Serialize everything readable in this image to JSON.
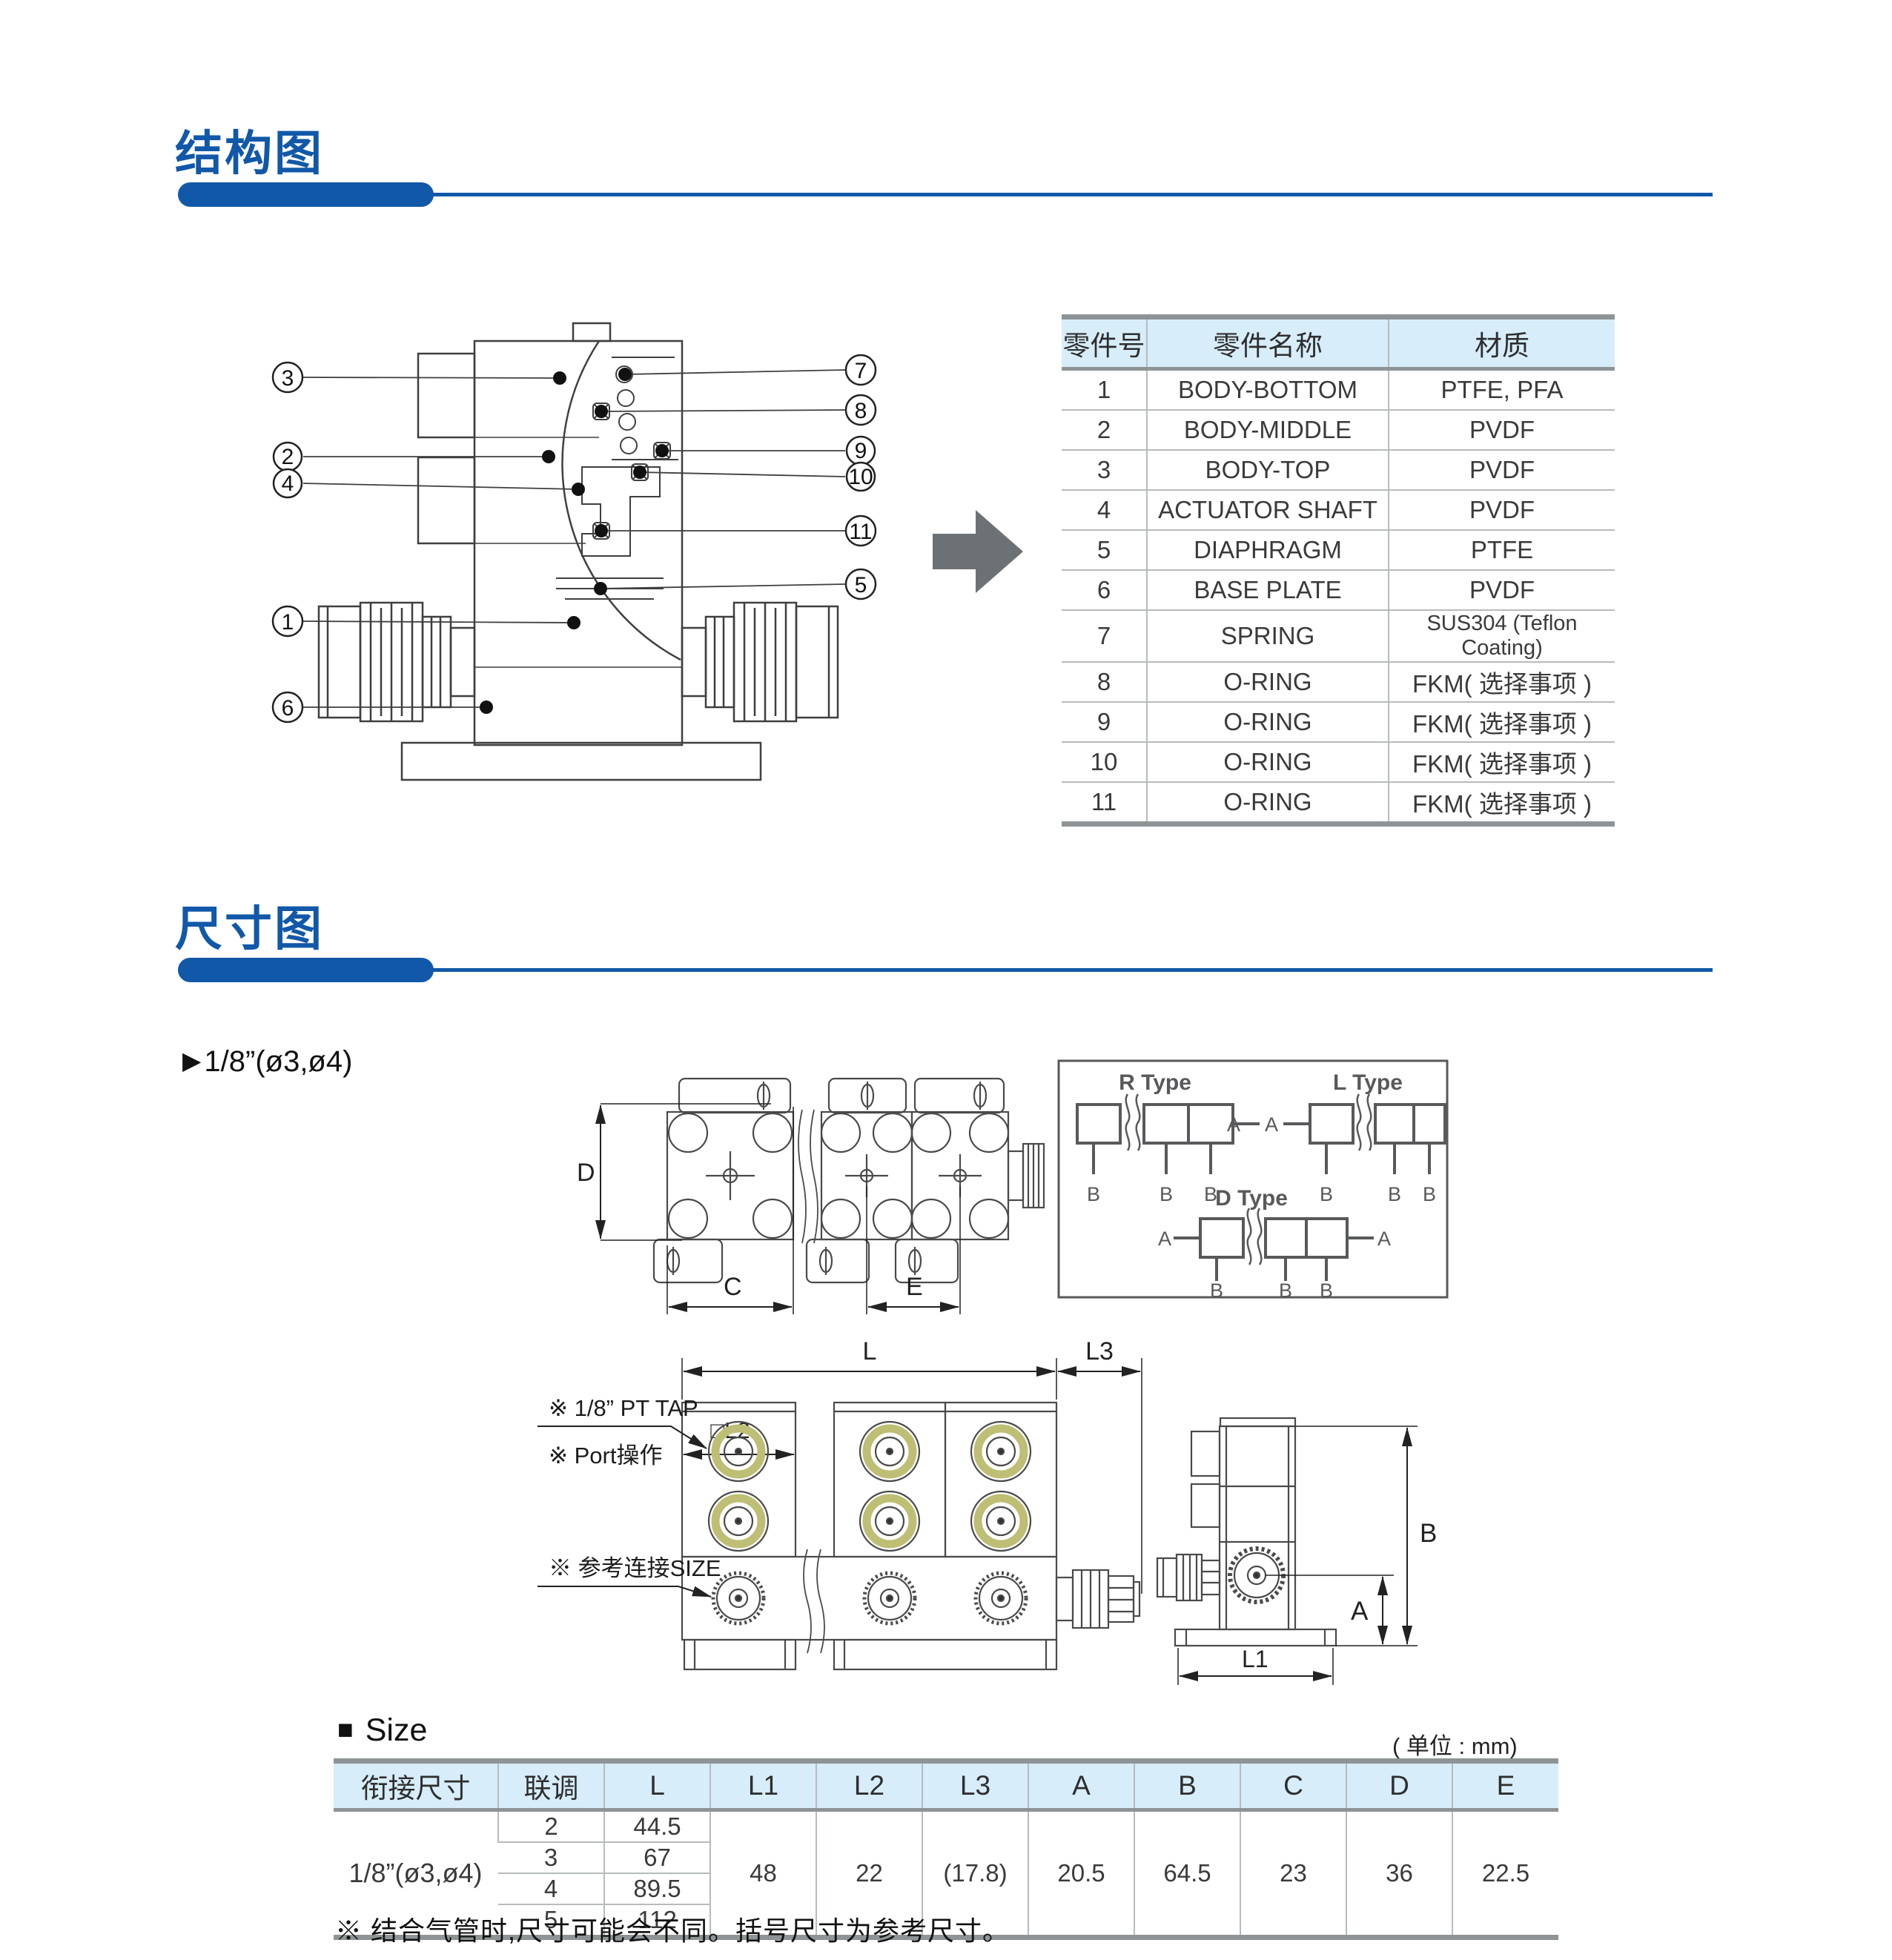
{
  "colors": {
    "accent_blue": "#1158A8",
    "table_header_bg": "#D7EDF9",
    "heavy_border_gray": "#8E9396",
    "port_ring_olive": "#BEBE74",
    "arrow_gray": "#6C7176"
  },
  "structure_section": {
    "title": "结构图",
    "parts_table": {
      "headers": [
        "零件号",
        "零件名称",
        "材质"
      ],
      "rows": [
        [
          "1",
          "BODY-BOTTOM",
          "PTFE, PFA"
        ],
        [
          "2",
          "BODY-MIDDLE",
          "PVDF"
        ],
        [
          "3",
          "BODY-TOP",
          "PVDF"
        ],
        [
          "4",
          "ACTUATOR SHAFT",
          "PVDF"
        ],
        [
          "5",
          "DIAPHRAGM",
          "PTFE"
        ],
        [
          "6",
          "BASE PLATE",
          "PVDF"
        ],
        [
          "7",
          "SPRING",
          "SUS304 (Teflon Coating)"
        ],
        [
          "8",
          "O-RING",
          "FKM( 选择事项 )"
        ],
        [
          "9",
          "O-RING",
          "FKM( 选择事项 )"
        ],
        [
          "10",
          "O-RING",
          "FKM( 选择事项 )"
        ],
        [
          "11",
          "O-RING",
          "FKM( 选择事项 )"
        ]
      ]
    },
    "callouts": {
      "c1": "1",
      "c2": "2",
      "c3": "3",
      "c4": "4",
      "c5": "5",
      "c6": "6",
      "c7": "7",
      "c8": "8",
      "c9": "9",
      "c10": "10",
      "c11": "11"
    }
  },
  "dimension_section": {
    "title": "尺寸图",
    "variant_pointer": "▶",
    "variant_label": "1/8”(ø3,ø4)",
    "type_box": {
      "r_type": "R Type",
      "l_type": "L Type",
      "d_type": "D Type",
      "port_a": "A",
      "port_b": "B"
    },
    "dim_labels": {
      "d": "D",
      "c": "C",
      "e": "E",
      "l": "L",
      "l2": "□L2",
      "l3": "L3",
      "a": "A",
      "b": "B",
      "l1": "L1"
    },
    "front_notes": {
      "pt_tap": "※ 1/8”  PT TAP",
      "port_op": "※ Port操作",
      "ref_size": "※ 参考连接SIZE"
    }
  },
  "size_section": {
    "bullet": "■",
    "title": "Size",
    "unit_label": "( 单位 : mm)",
    "table": {
      "headers": [
        "衔接尺寸",
        "联调",
        "L",
        "L1",
        "L2",
        "L3",
        "A",
        "B",
        "C",
        "D",
        "E"
      ],
      "connection_size": "1/8”(ø3,ø4)",
      "l_rows": [
        [
          "2",
          "44.5"
        ],
        [
          "3",
          "67"
        ],
        [
          "4",
          "89.5"
        ],
        [
          "5",
          "112"
        ]
      ],
      "shared": {
        "l1": "48",
        "l2": "22",
        "l3": "(17.8)",
        "a": "20.5",
        "b": "64.5",
        "c": "23",
        "d": "36",
        "e": "22.5"
      }
    },
    "footnote": "※ 结合气管时,尺寸可能会不同。括号尺寸为参考尺寸。"
  }
}
